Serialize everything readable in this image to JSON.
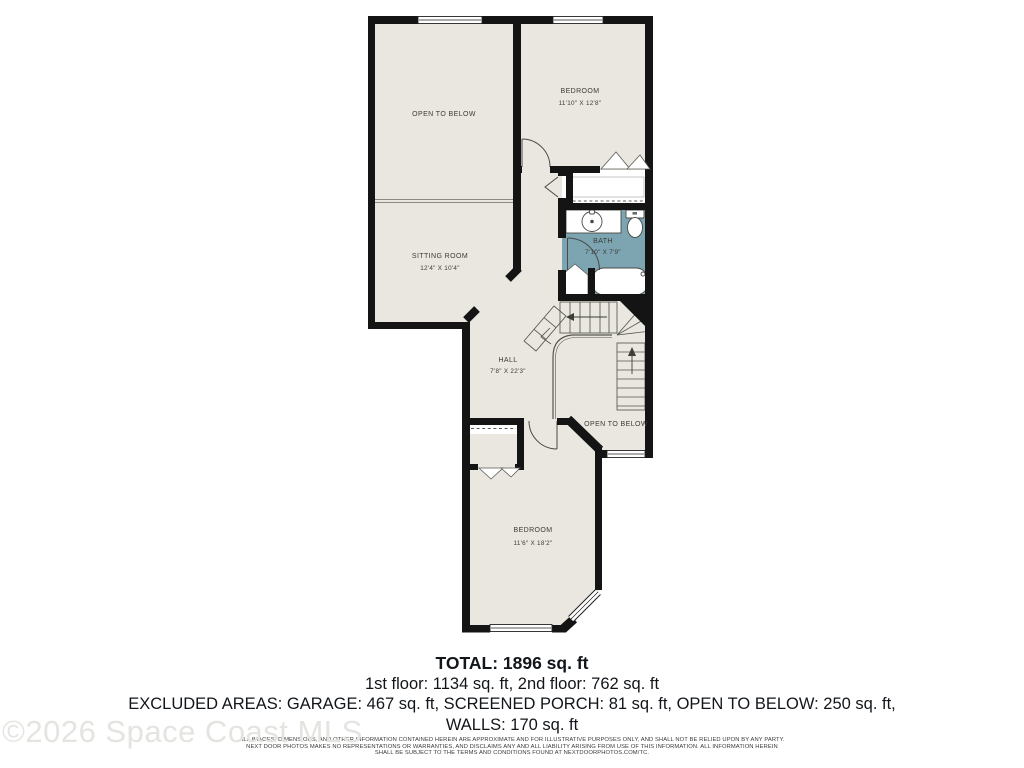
{
  "floorplan": {
    "colors": {
      "wall": "#141414",
      "room_fill": "#e9e7df",
      "bath_fill": "#7ca4b1",
      "railing": "#8b8b85"
    },
    "labels": {
      "open_below_upper": {
        "name": "OPEN TO BELOW"
      },
      "bedroom_upper": {
        "name": "BEDROOM",
        "dims": "11'10\" X 12'8\""
      },
      "sitting_room": {
        "name": "SITTING ROOM",
        "dims": "12'4\" X 10'4\""
      },
      "bath": {
        "name": "BATH",
        "dims": "7'10\" X 7'9\""
      },
      "hall": {
        "name": "HALL",
        "dims": "7'8\" X 22'3\""
      },
      "open_below_lower": {
        "name": "OPEN TO BELOW"
      },
      "bedroom_lower": {
        "name": "BEDROOM",
        "dims": "11'6\" X 18'2\""
      }
    }
  },
  "summary": {
    "total": "TOTAL: 1896 sq. ft",
    "floors": "1st floor: 1134 sq. ft, 2nd floor: 762 sq. ft",
    "excluded_line1": "EXCLUDED AREAS: GARAGE: 467 sq. ft, SCREENED PORCH: 81 sq. ft, OPEN TO BELOW: 250 sq. ft,",
    "excluded_line2": "WALLS: 170 sq. ft"
  },
  "disclaimer": {
    "line1": "ALL IMAGES, DIMENSIONS, AND OTHER INFORMATION CONTAINED HEREIN ARE APPROXIMATE AND FOR ILLUSTRATIVE PURPOSES ONLY, AND SHALL NOT BE RELIED UPON BY ANY PARTY.",
    "line2": "NEXT DOOR PHOTOS MAKES NO REPRESENTATIONS OR WARRANTIES, AND DISCLAIMS ANY AND ALL LIABILITY ARISING FROM USE OF THIS INFORMATION. ALL INFORMATION HEREIN",
    "line3": "SHALL BE SUBJECT TO THE TERMS AND CONDITIONS FOUND AT NEXTDOORPHOTOS.COM/TC."
  },
  "watermark": "©2026 Space Coast MLS"
}
